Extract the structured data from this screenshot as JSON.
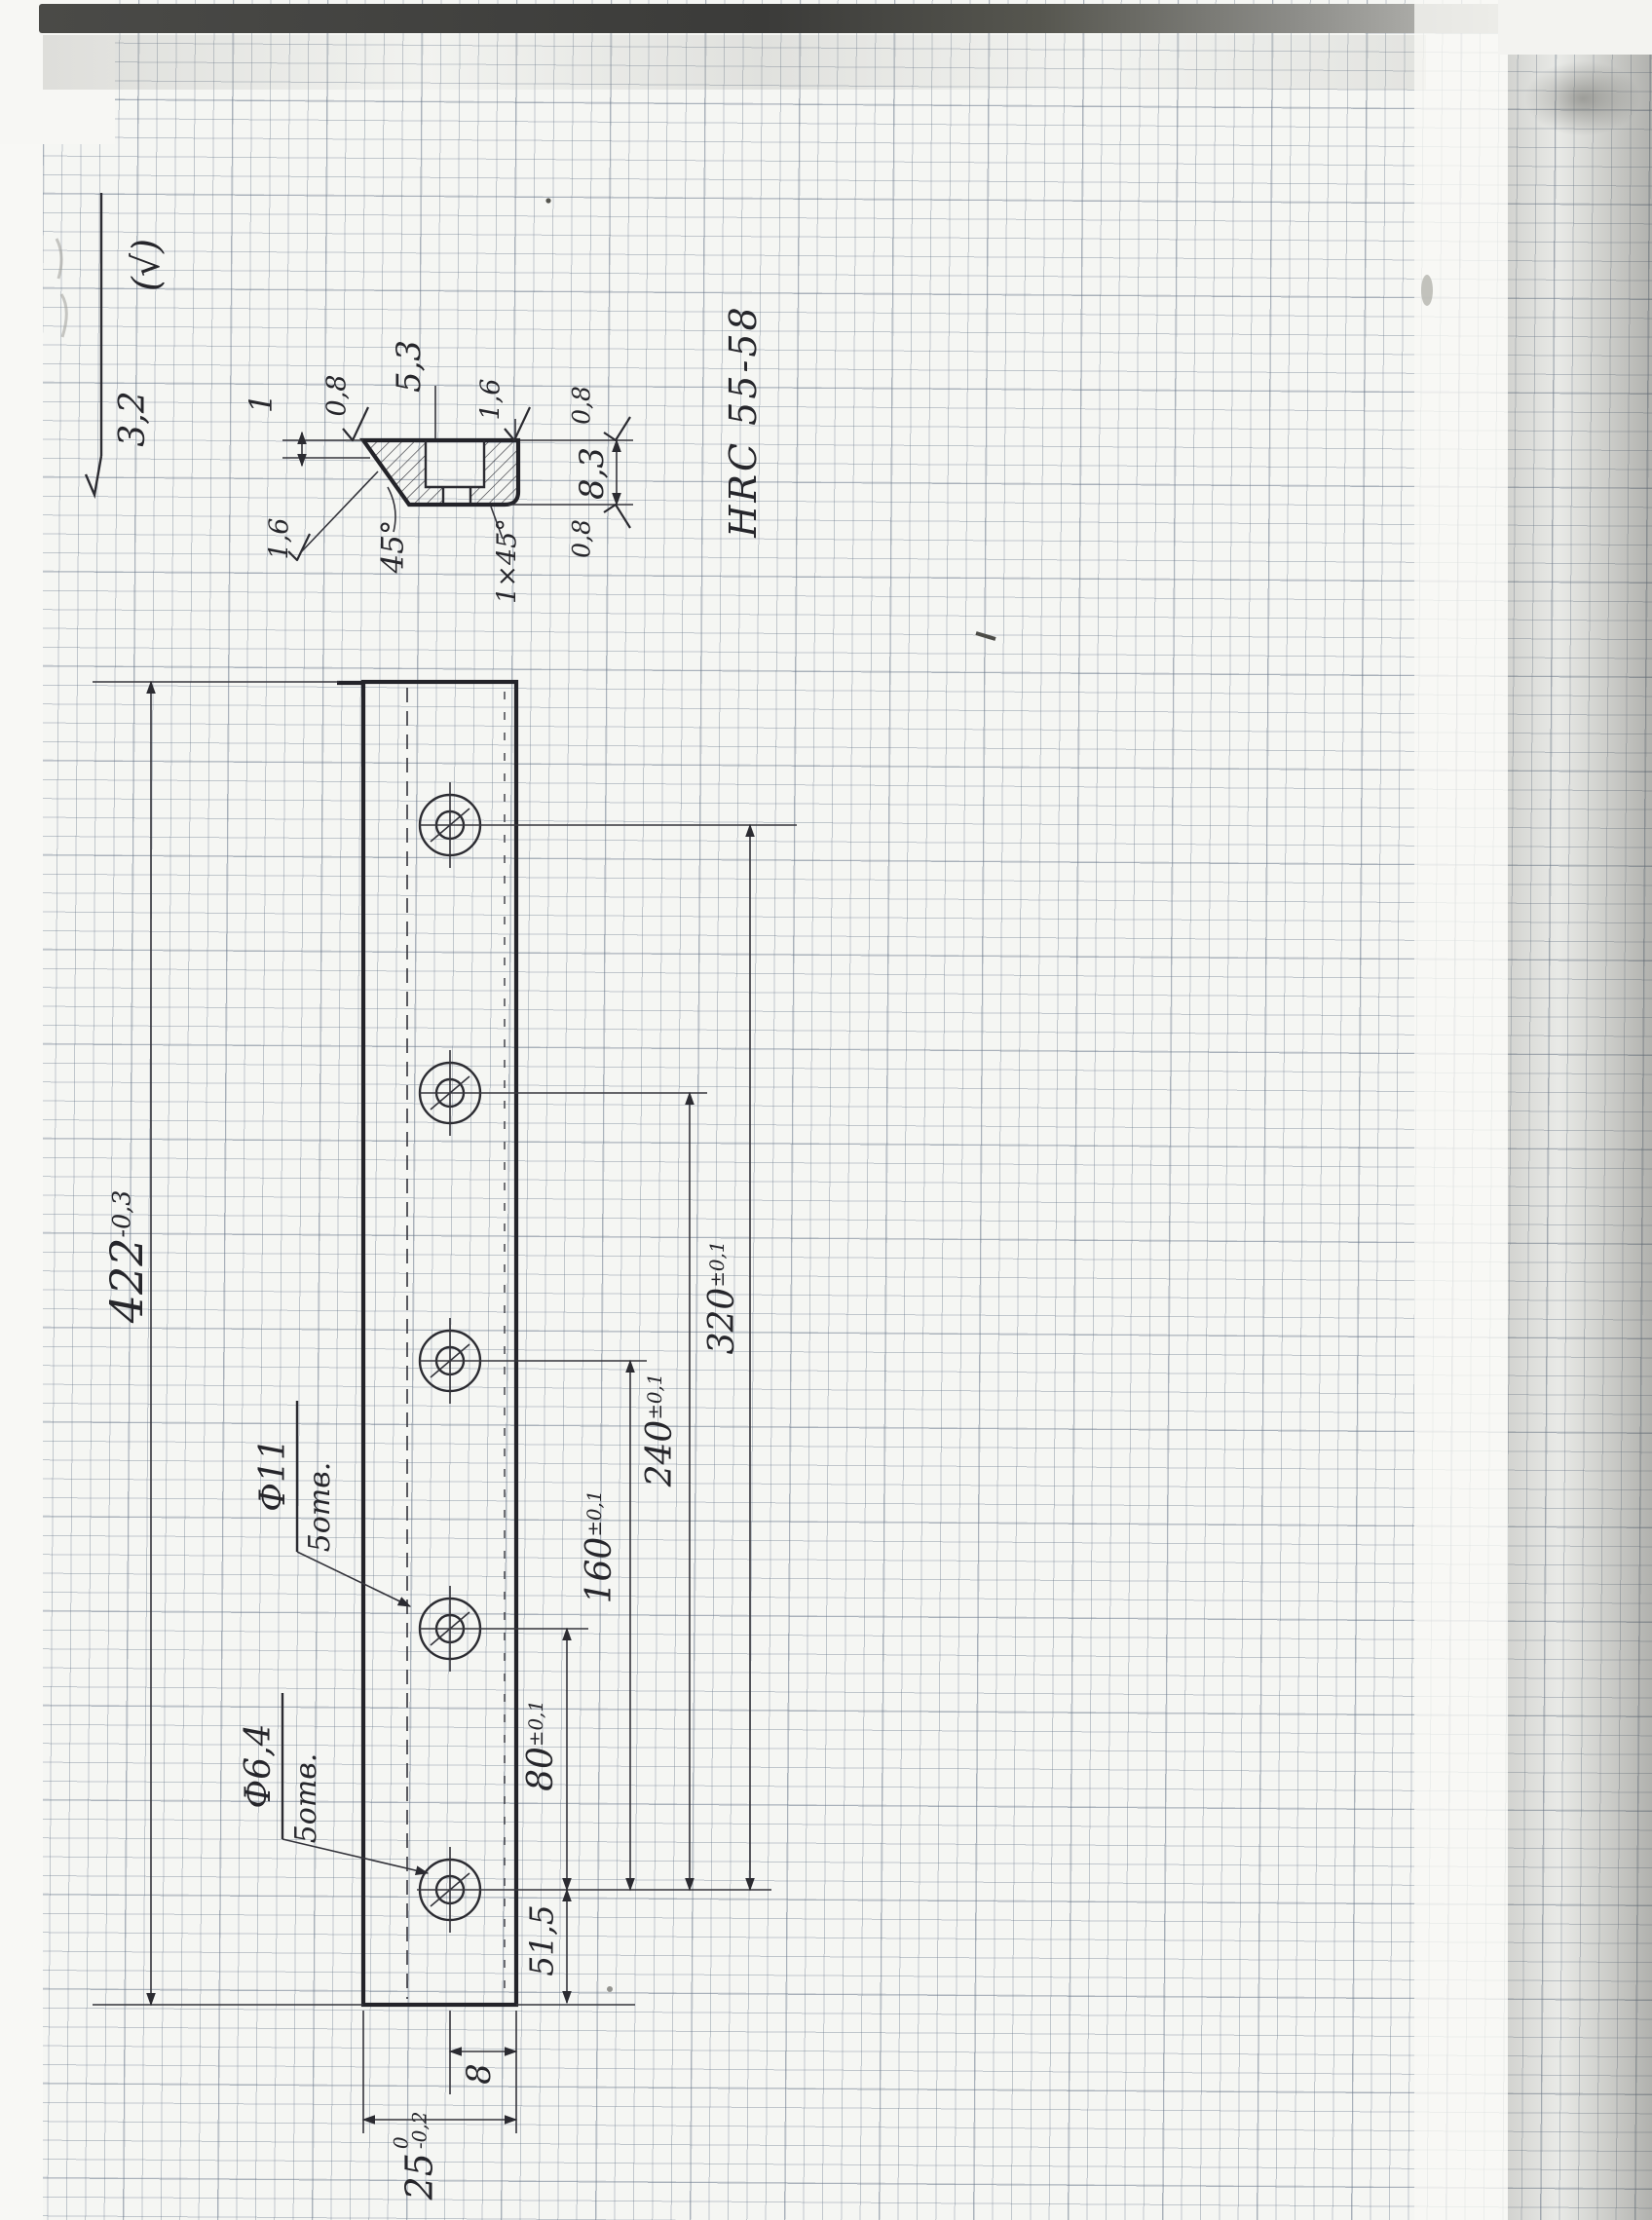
{
  "general_note": {
    "roughness_value": "3,2",
    "bracket_mark": "(√)"
  },
  "hardness_note": "HRC 55-58",
  "section_detail": {
    "dim_step": "1",
    "roughness_top": "0,8",
    "groove_width": "5,3",
    "roughness_groove": "1,6",
    "height": "8,3",
    "roughness_height_top": "0,8",
    "roughness_height_bottom": "0,8",
    "roughness_chamfer": "1,6",
    "chamfer_angle": "45°",
    "chamfer_note": "1×45°"
  },
  "main_view": {
    "length_value": "422",
    "length_tolerance": "-0,3",
    "large_holes_dia": "Ф11",
    "large_holes_qty": "5отв.",
    "small_holes_dia": "Ф6,4",
    "small_holes_qty": "5отв.",
    "chain_dims": [
      {
        "value": "80",
        "tolerance": "±0,1"
      },
      {
        "value": "160",
        "tolerance": "±0,1"
      },
      {
        "value": "240",
        "tolerance": "±0,1"
      },
      {
        "value": "320",
        "tolerance": "±0,1"
      }
    ],
    "end_offset": "51,5",
    "hole_edge_offset": "8",
    "width_value": "25",
    "width_tolerance_upper": "0",
    "width_tolerance_lower": "-0,2"
  }
}
